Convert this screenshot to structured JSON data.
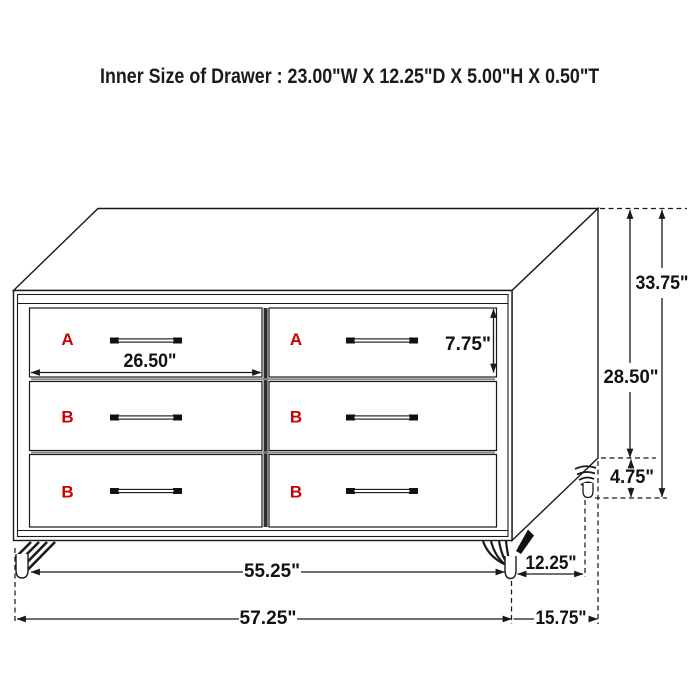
{
  "header": {
    "title": "Inner Size of Drawer : 23.00\"W X 12.25\"D X 5.00\"H X 0.50\"T"
  },
  "drawer_letters": {
    "a": "A",
    "b": "B"
  },
  "dimensions": {
    "drawer_width": "26.50\"",
    "drawer_face_height": "7.75\"",
    "overall_height": "33.75\"",
    "body_height": "28.50\"",
    "leg_height": "4.75\"",
    "front_leg_span": "55.25\"",
    "side_leg_span": "12.25\"",
    "overall_width": "57.25\"",
    "overall_depth": "15.75\""
  },
  "colors": {
    "label_red": "#cc0000",
    "line": "#1a1a1a"
  }
}
